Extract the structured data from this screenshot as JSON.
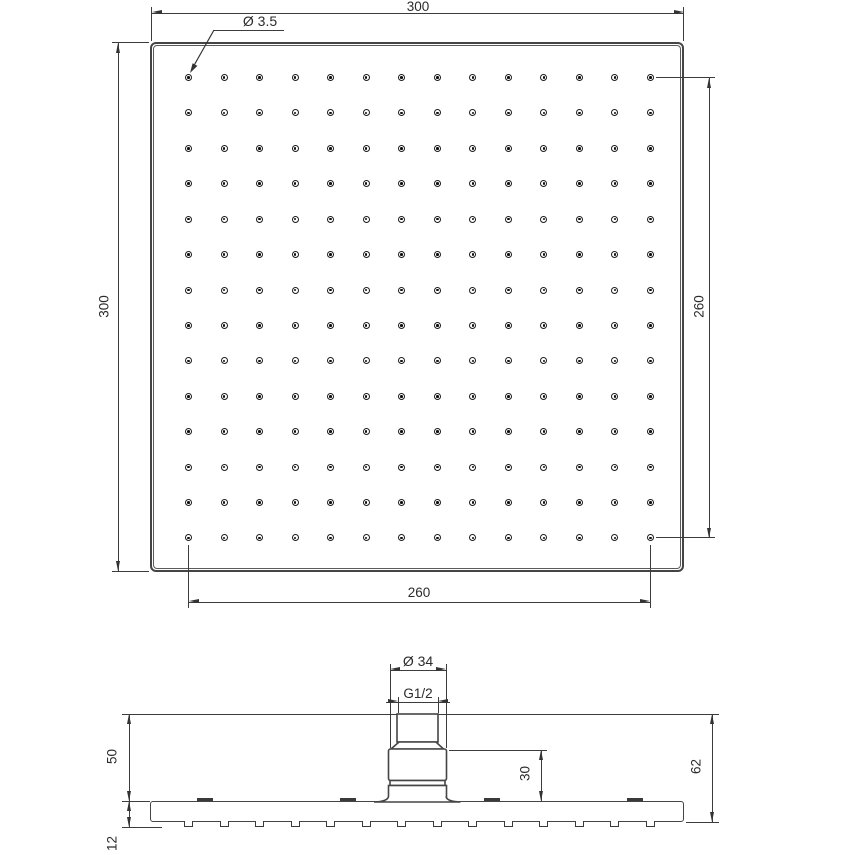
{
  "top_view": {
    "width_label": "300",
    "height_label": "300",
    "hole_span_h_label": "260",
    "hole_span_v_label": "260",
    "hole_diameter_label": "Ø 3.5",
    "hole_rows": 14,
    "hole_cols": 14
  },
  "side_view": {
    "connector_diameter_label": "Ø 34",
    "thread_label": "G1/2",
    "connector_height_label": "50",
    "plate_thickness_label": "12",
    "total_height_label": "62",
    "body_height_label": "30",
    "nozzle_count": 14,
    "tab_count": 4
  },
  "colors": {
    "outline": "#454545",
    "dimension": "#3c3c3c",
    "text": "#2b2b2b",
    "background": "#ffffff"
  }
}
